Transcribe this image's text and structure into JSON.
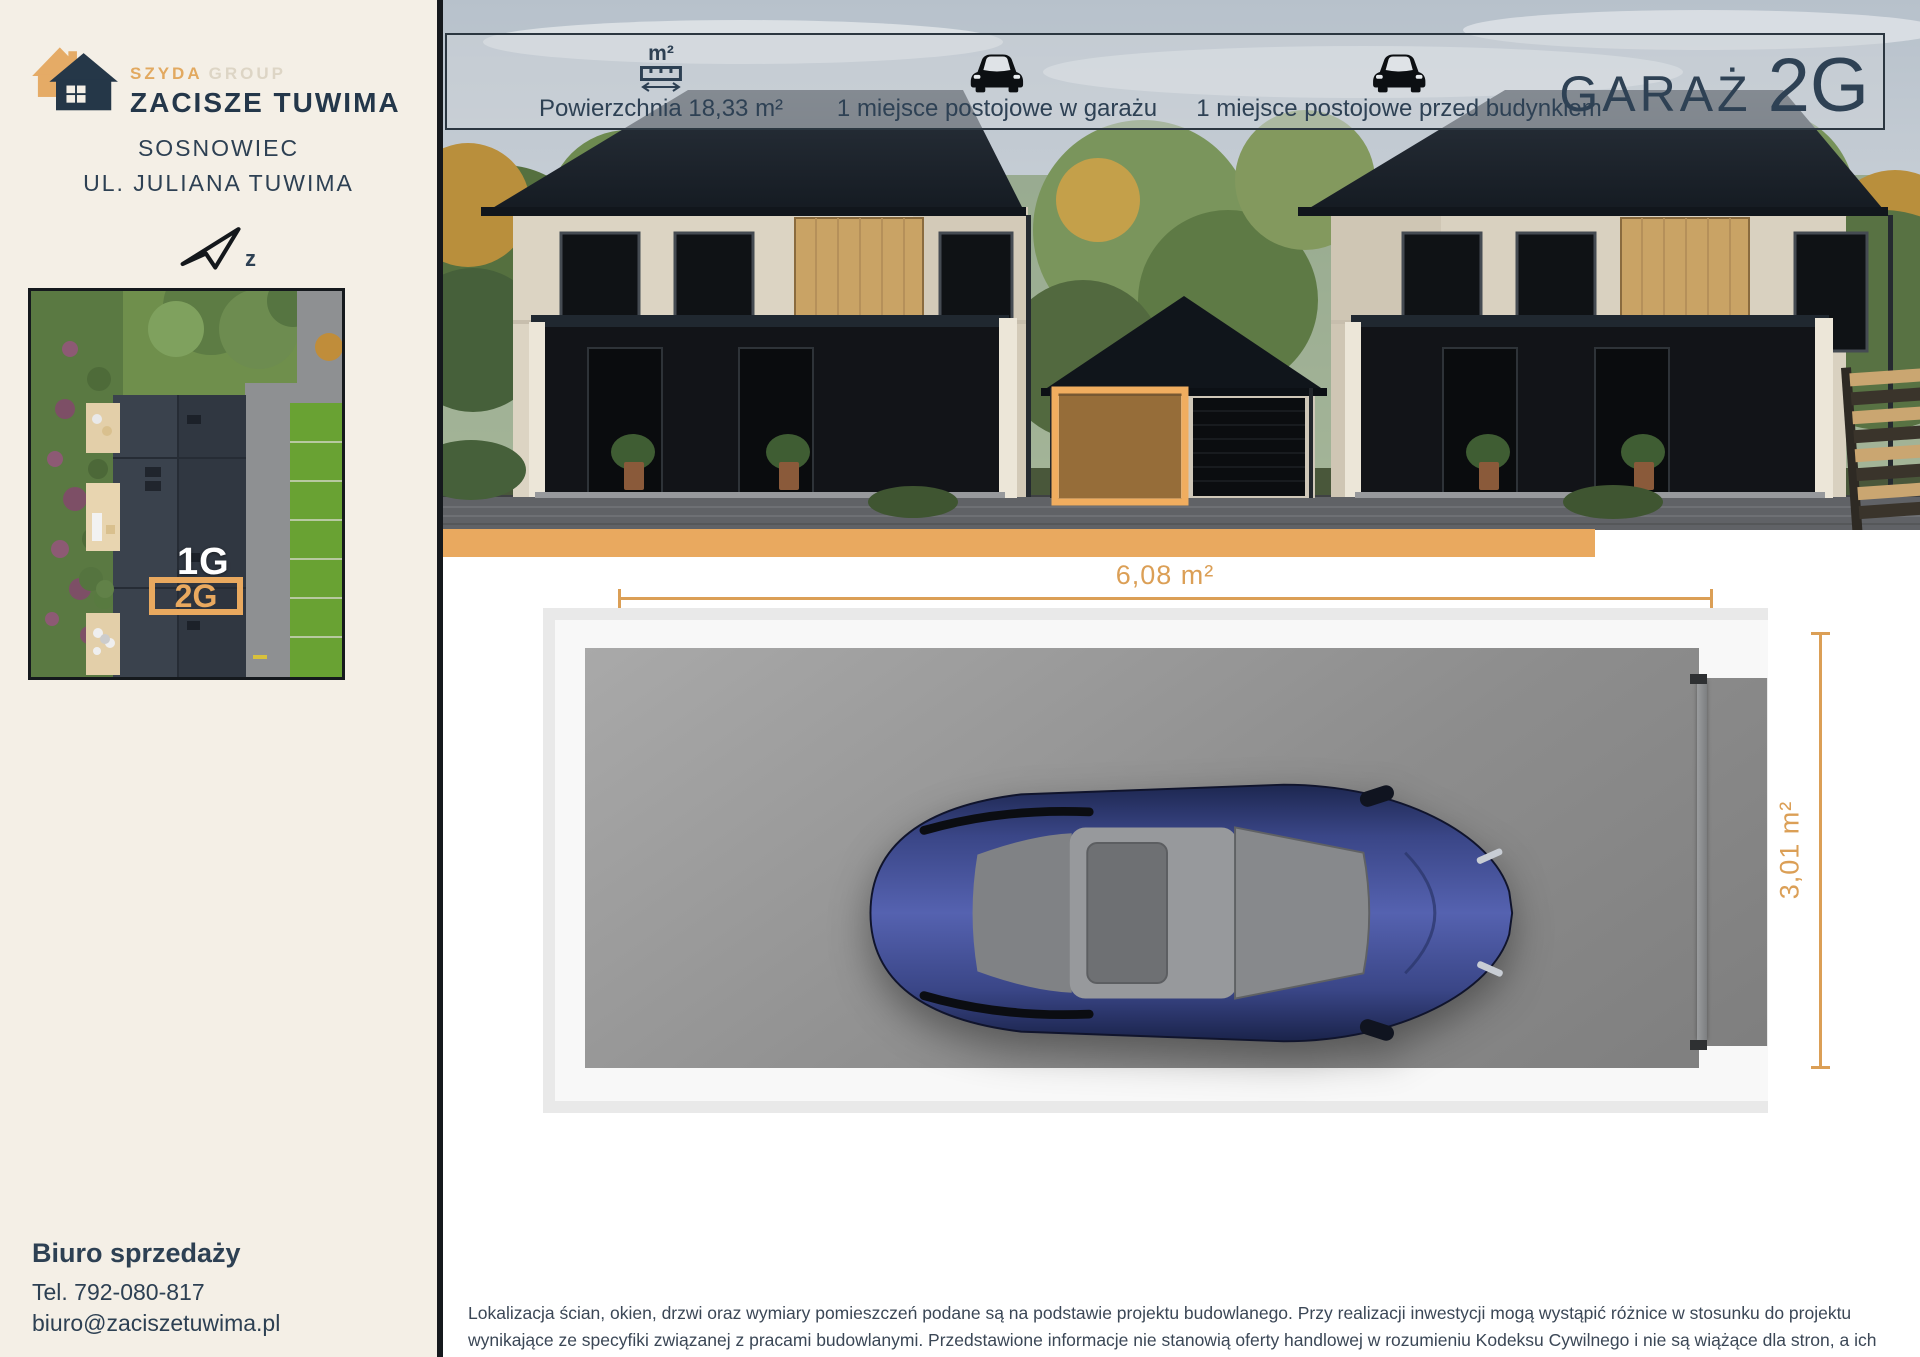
{
  "colors": {
    "accent_orange": "#E9A95F",
    "navy": "#2E4154",
    "sidebar_cream": "#F4EFE6",
    "dimension_orange": "#DB9F56"
  },
  "icons": {
    "logo": "double-house-icon",
    "north": "north-arrow-icon",
    "area": "ruler-m2-icon",
    "parking_garage": "car-icon",
    "parking_outside": "car-icon"
  },
  "sidebar": {
    "logo": {
      "brand_primary": "SZYDA",
      "brand_secondary": "GROUP",
      "name": "ZACISZE TUWIMA"
    },
    "location_line1": "SOSNOWIEC",
    "location_line2": "UL. JULIANA TUWIMA",
    "north_label": "z",
    "siteplan": {
      "unit_above_label": "1G",
      "unit_current_label": "2G"
    },
    "office": {
      "title": "Biuro sprzedaży",
      "phone": "Tel. 792-080-817",
      "email": "biuro@zaciszetuwima.pl"
    }
  },
  "header": {
    "area_icon_label": "m²",
    "area_text": "Powierzchnia 18,33 m²",
    "parking_garage_text": "1 miejsce postojowe w garażu",
    "parking_outside_text": "1 miejsce postojowe przed budynkiem",
    "title": "GARAŻ",
    "unit": "2G"
  },
  "plan": {
    "width_label": "6,08 m²",
    "height_label": "3,01 m²"
  },
  "disclaimer": "Lokalizacja ścian, okien, drzwi oraz wymiary pomieszczeń podane są na podstawie projektu budowlanego. Przy realizacji inwestycji mogą wystąpić różnice w stosunku do projektu wynikające ze specyfiki związanej z pracami budowlanymi. Przedstawione informacje nie stanowią oferty handlowej w rozumieniu Kodeksu Cywilnego i nie są wiążące dla stron, a ich charakter jest wyłącznie poglądowy"
}
